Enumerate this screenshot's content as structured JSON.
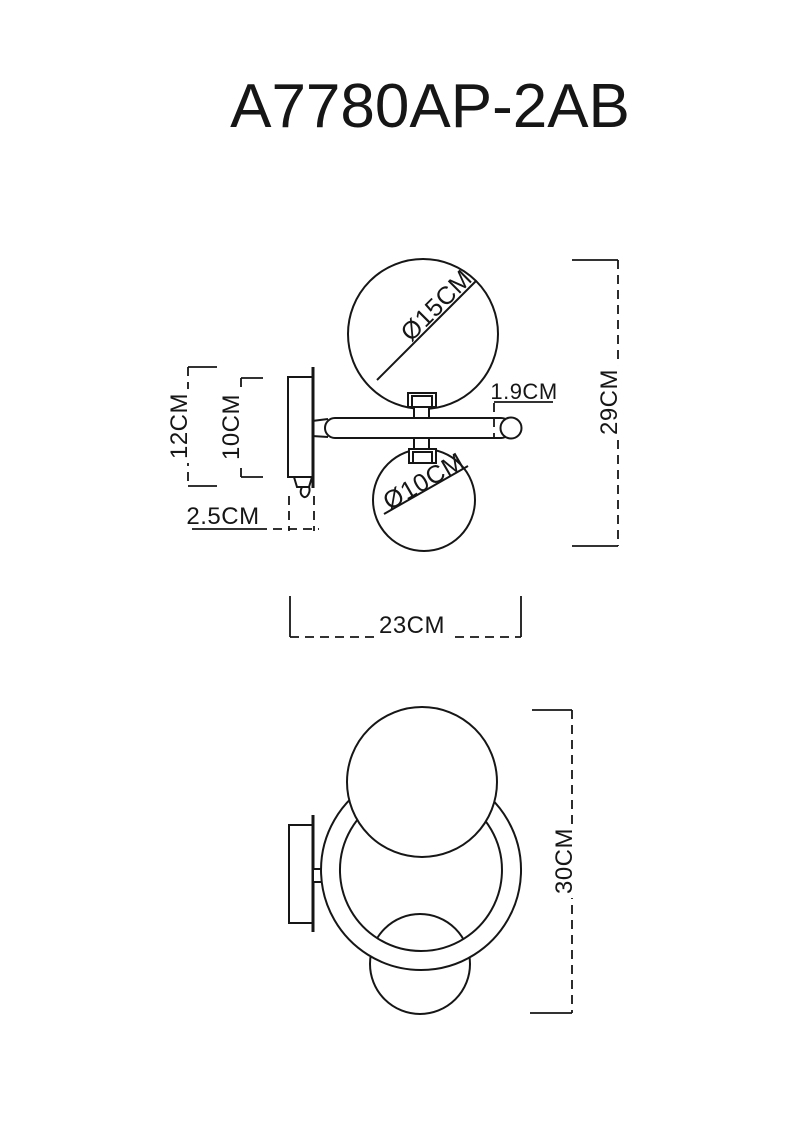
{
  "page": {
    "background_color": "#ffffff",
    "line_color": "#161616"
  },
  "title": "A7780AP-2AB",
  "side_view": {
    "name": "side-projection-drawing",
    "labels": {
      "large_globe_diameter": "Ø15CM",
      "small_globe_diameter": "Ø10CM",
      "arm_diameter": "1.9CM",
      "overall_height": "29CM",
      "backplate_height": "12CM",
      "mount_body_height": "10CM",
      "mount_depth": "2.5CM",
      "overall_depth": "23CM"
    }
  },
  "front_view": {
    "name": "front-projection-drawing",
    "labels": {
      "overall_height": "30CM"
    }
  }
}
